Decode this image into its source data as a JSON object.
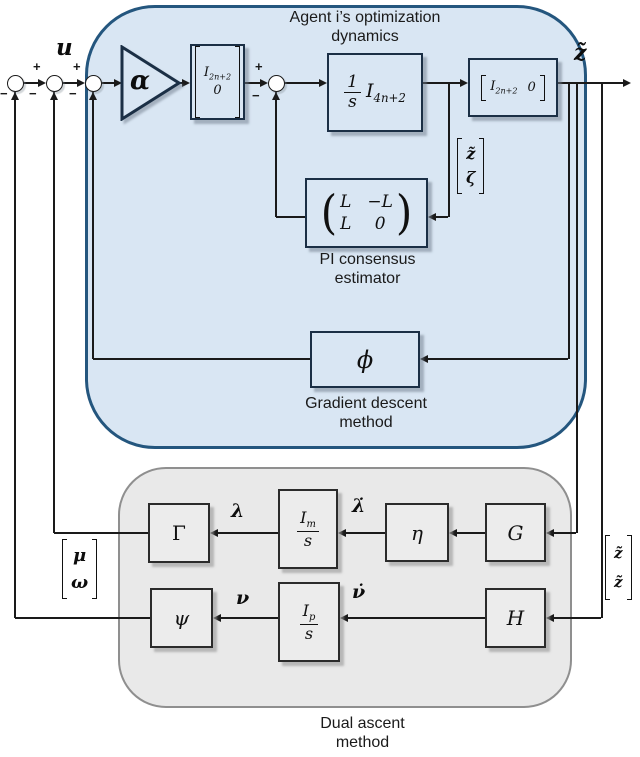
{
  "agent": {
    "title_line1": "Agent i’s optimization",
    "title_line2": "dynamics",
    "alpha": "α",
    "in_matrix": {
      "e1_base": "I",
      "e1_sub": "2n+2",
      "e2": "0"
    },
    "integrator": {
      "num": "1",
      "den": "s",
      "i_base": "I",
      "i_sub": "4n+2"
    },
    "out_matrix": {
      "e1_base": "I",
      "e1_sub": "2n+2",
      "e2": "0"
    },
    "pi": {
      "lp": "(",
      "rp": ")",
      "r1c1": "L",
      "r1c2": "−L",
      "r2c1": "L",
      "r2c2": "0",
      "caption1": "PI consensus",
      "caption2": "estimator"
    },
    "grad": {
      "symbol": "ϕ",
      "caption1": "Gradient descent",
      "caption2": "method"
    }
  },
  "dual": {
    "caption1": "Dual ascent",
    "caption2": "method",
    "gamma": "Γ",
    "psi": "ψ",
    "eta": "η",
    "g": "G",
    "h": "H",
    "im": {
      "num_base": "I",
      "num_sub": "m",
      "den": "s"
    },
    "ip": {
      "num_base": "I",
      "num_sub": "p",
      "den": "s"
    },
    "lambda": "λ",
    "lambda_dot": "λ̇",
    "nu": "ν",
    "nu_dot": "ν̇"
  },
  "signals": {
    "u": "u",
    "z_out": "z̃",
    "vec_z_zeta": {
      "e1": "z̃",
      "e2": "ζ"
    },
    "vec_mu_omega": {
      "e1": "μ",
      "e2": "ω"
    },
    "vec_z_z": {
      "e1": "z̃",
      "e2": "z̃"
    }
  },
  "signs": {
    "plus": "+",
    "minus": "−"
  },
  "colors": {
    "agent_fill": "#d9e6f3",
    "agent_border": "#24567e",
    "dual_fill": "#e9e9e9",
    "dual_border": "#8f8f8f",
    "line": "#1a1a1a"
  }
}
